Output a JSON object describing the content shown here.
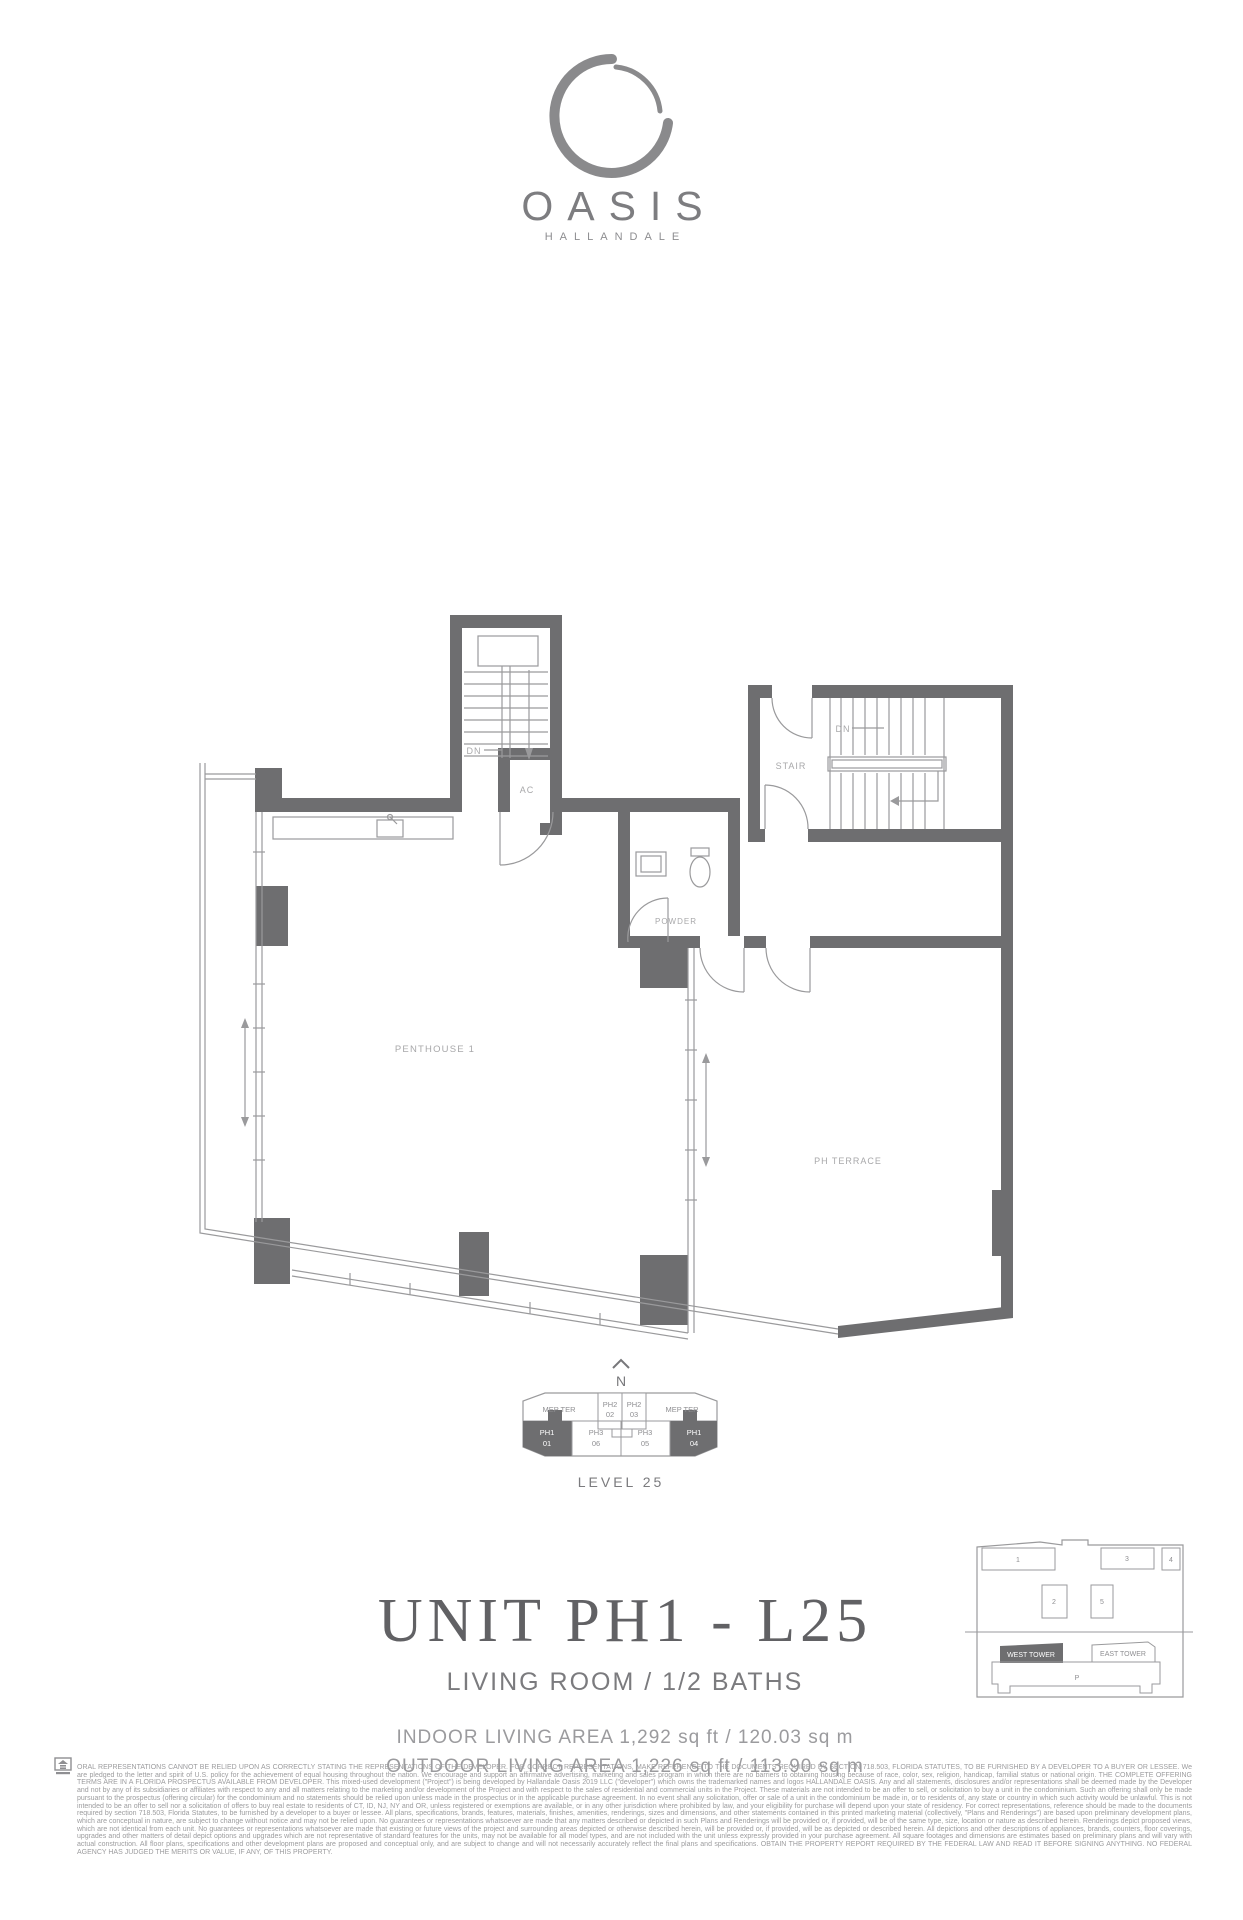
{
  "brand": {
    "name": "OASIS",
    "location": "HALLANDALE"
  },
  "theme": {
    "wall_color": "#6e6e70",
    "line_color": "#9a9a9c",
    "plan_label_color": "#a8a8aa",
    "title_color": "#616164",
    "logo_color": "#8a8a8c"
  },
  "plan": {
    "labels": {
      "dn_top": "DN",
      "ac": "AC",
      "stair": "STAIR",
      "dn_right": "DN",
      "powder": "POWDER",
      "penthouse": "PENTHOUSE 1",
      "terrace": "PH TERRACE"
    }
  },
  "keyplan": {
    "compass": "N",
    "level": "LEVEL 25",
    "cells": {
      "mep_left": "MEP TER",
      "mep_right": "MEP TER",
      "ph2_02": {
        "l1": "PH2",
        "l2": "02"
      },
      "ph2_03": {
        "l1": "PH2",
        "l2": "03"
      },
      "ph1_01": {
        "l1": "PH1",
        "l2": "01"
      },
      "ph3_06": {
        "l1": "PH3",
        "l2": "06"
      },
      "ph3_05": {
        "l1": "PH3",
        "l2": "05"
      },
      "ph1_04": {
        "l1": "PH1",
        "l2": "04"
      }
    }
  },
  "unit": {
    "title": "UNIT PH1 - L25",
    "subtitle": "LIVING ROOM / 1/2 BATHS",
    "indoor_area": "INDOOR LIVING AREA 1,292 sq ft / 120.03 sq m",
    "outdoor_area": "OUTDOOR LIVING AREA 1,226 sq ft / 113.90 sq m"
  },
  "site": {
    "buildings": [
      "1",
      "2",
      "3",
      "4",
      "5"
    ],
    "west_tower": "WEST TOWER",
    "east_tower": "EAST TOWER",
    "parking": "P"
  },
  "legal": {
    "text": "ORAL REPRESENTATIONS CANNOT BE RELIED UPON AS CORRECTLY STATING THE REPRESENTATIONS OF THE DEVELOPER. FOR CORRECT REPRESENTATIONS, MAKE REFERENCE TO THE DOCUMENTS REQUIRED BY SECTION 718.503, FLORIDA STATUTES, TO BE FURNISHED BY A DEVELOPER TO A BUYER OR LESSEE.  We are pledged to the letter and spirit of U.S. policy for the achievement of equal housing throughout the nation. We encourage and support an affirmative advertising, marketing and sales program in which there are no barriers to obtaining housing because of race, color, sex, religion, handicap, familial status or national origin. THE COMPLETE OFFERING TERMS ARE IN A FLORIDA PROSPECTUS AVAILABLE FROM DEVELOPER.  This mixed-used development (\"Project\") is being developed by Hallandale Oasis 2019 LLC (\"developer\") which owns the trademarked names and logos HALLANDALE OASIS. Any and all statements, disclosures and/or representations shall be deemed made by the Developer and not by any of its subsidiaries or affiliates with respect to any and all matters relating to the marketing and/or development of the Project and with respect to the sales of residential and commercial units in the Project.  These materials are not intended to be an offer to sell, or solicitation to buy a unit in the condominium. Such an offering shall only be made pursuant to the prospectus (offering circular) for the condominium and no statements should be relied upon unless made in the prospectus or in the applicable purchase agreement. In no event shall any solicitation, offer or sale of a unit in the condominium be made in, or to residents of, any state or country in which such activity would be unlawful. This is not intended to be an offer to sell nor a solicitation of offers to buy real estate to residents of CT, ID, NJ, NY and OR, unless registered or exemptions are available, or in any other jurisdiction where prohibited by law, and your eligibility for purchase will depend upon your state of residency. For correct representations, reference should be made to the documents required by section 718.503, Florida Statutes, to be furnished by a developer to a buyer or lessee.  All plans, specifications, brands, features, materials, finishes, amenities, renderings, sizes and dimensions, and other statements contained in this printed marketing material (collectively, \"Plans and Renderings\") are based upon preliminary development plans, which are conceptual in nature, are subject to change without notice and may not be relied upon. No guarantees or representations whatsoever are made that any matters described or depicted in such Plans and Renderings will be provided or, if provided, will be of the same type, size, location or nature as described herein. Renderings depict proposed views, which are not identical from each unit. No guarantees or representations whatsoever are made that existing or future views of the project and surrounding areas depicted or otherwise described herein, will be provided or, if provided, will be as depicted or described herein. All depictions and other descriptions of appliances, brands, counters, floor coverings, upgrades and other matters of detail depict options and upgrades which are not representative of standard features for the units, may not be available for all model types, and are not included with the unit unless expressly provided in your purchase agreement. All square footages and dimensions are estimates based on preliminary plans and will vary with actual construction. All floor plans, specifications and other development plans are proposed and conceptual only, and are subject to change and will not necessarily accurately reflect the final plans and specifications.  OBTAIN THE PROPERTY REPORT REQUIRED BY THE FEDERAL LAW AND READ IT BEFORE SIGNING ANYTHING. NO FEDERAL AGENCY HAS JUDGED THE MERITS OR VALUE, IF ANY, OF THIS PROPERTY."
  }
}
